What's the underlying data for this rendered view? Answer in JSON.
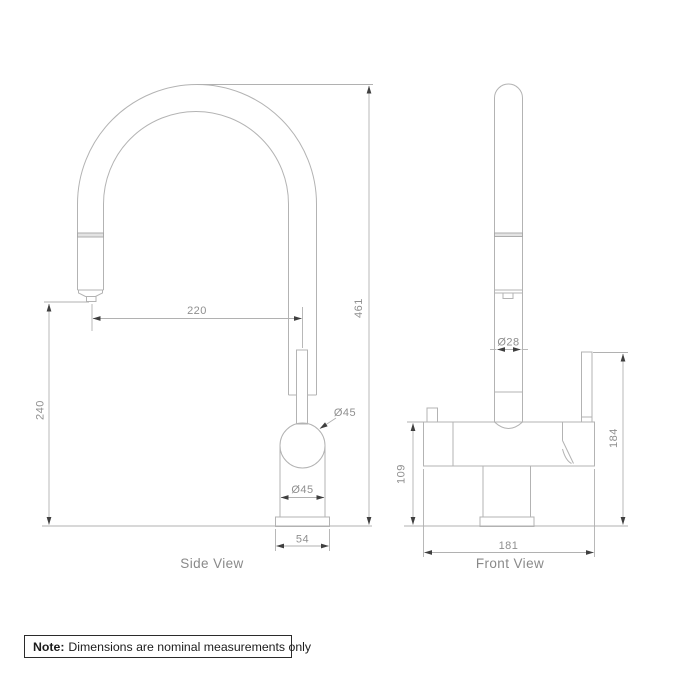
{
  "colors": {
    "line": "#b3b3b3",
    "dim_text": "#8f8f8f",
    "arrow": "#3f3f3f",
    "label_text": "#898989",
    "note_text": "#1c1c1c",
    "background": "#ffffff"
  },
  "side_view": {
    "label": "Side View",
    "dims": {
      "spout_reach": "220",
      "overall_height": "461",
      "spout_clearance": "240",
      "ball_diameter": "Ø45",
      "body_diameter": "Ø45",
      "base_width": "54"
    }
  },
  "front_view": {
    "label": "Front View",
    "dims": {
      "spout_diameter": "Ø28",
      "body_height": "109",
      "handle_height": "184",
      "overall_width": "181"
    }
  },
  "note": {
    "label": "Note:",
    "text": "Dimensions are nominal measurements only"
  }
}
